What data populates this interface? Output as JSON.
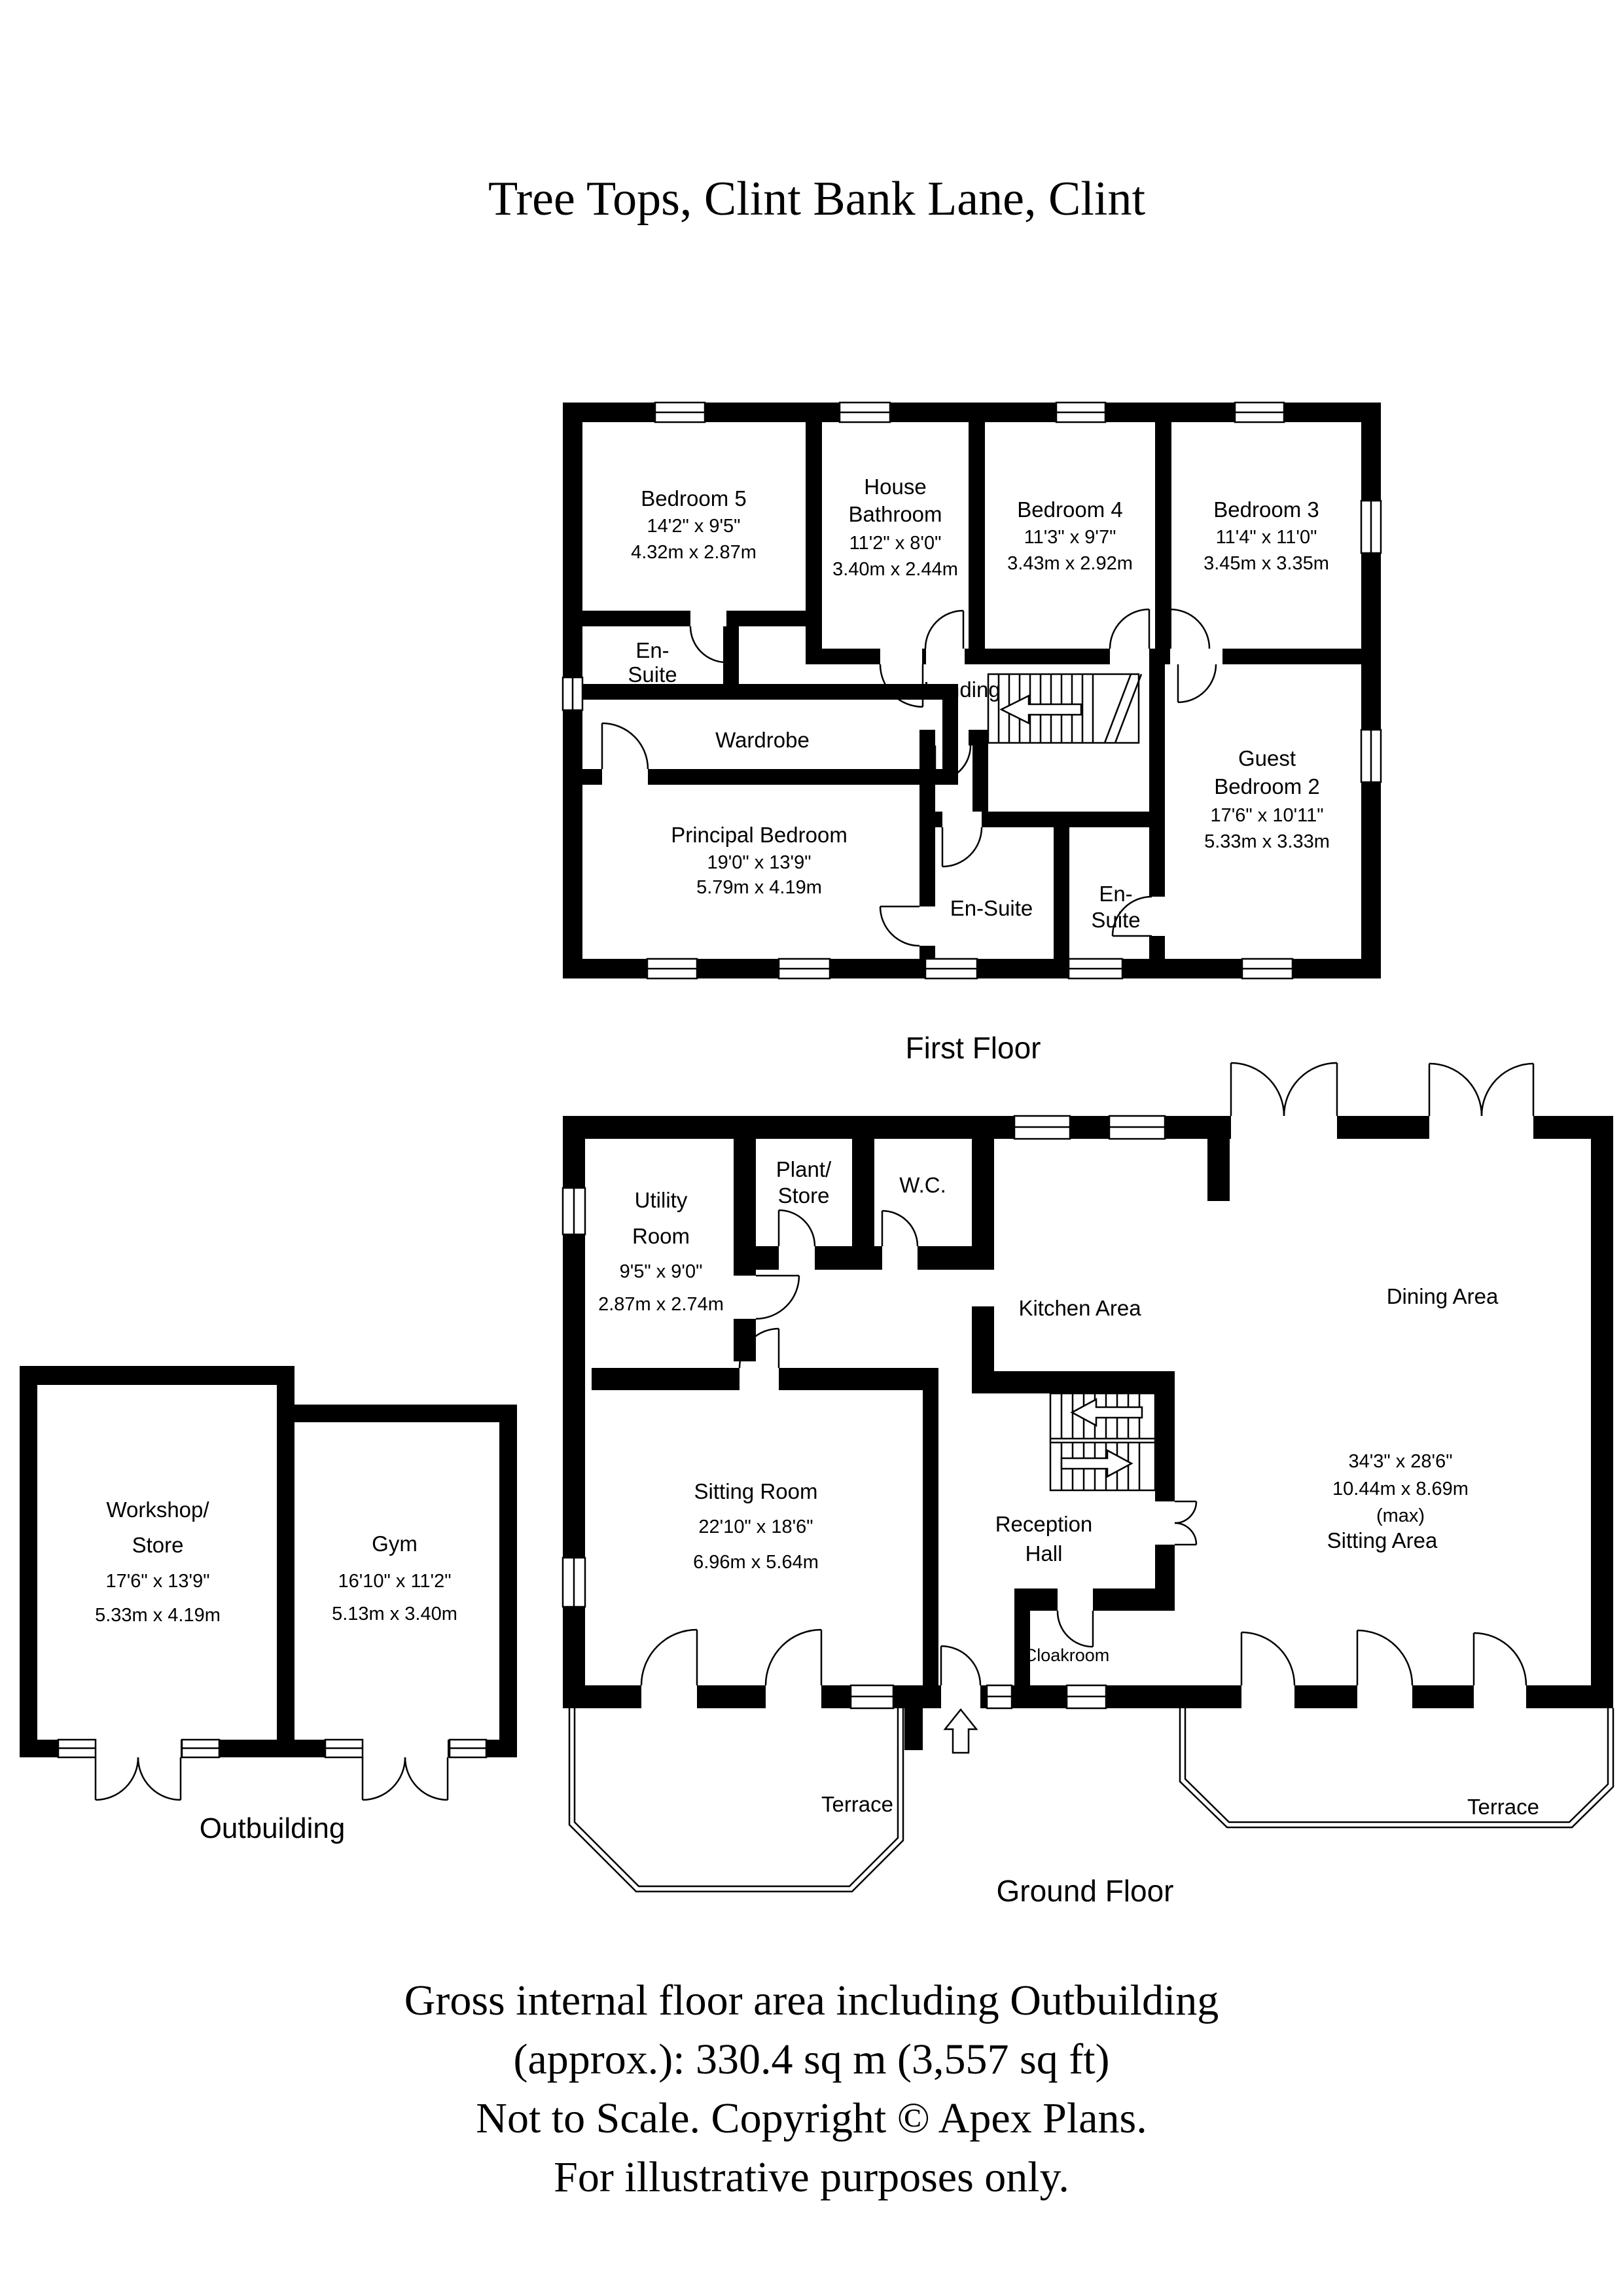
{
  "title": "Tree Tops, Clint Bank Lane, Clint",
  "first_floor": {
    "label": "First Floor",
    "rooms": {
      "bedroom5": {
        "name": "Bedroom 5",
        "dims_ft": "14'2\" x 9'5\"",
        "dims_m": "4.32m x 2.87m"
      },
      "house_bathroom": {
        "name_line1": "House",
        "name_line2": "Bathroom",
        "dims_ft": "11'2\" x 8'0\"",
        "dims_m": "3.40m x 2.44m"
      },
      "bedroom4": {
        "name": "Bedroom 4",
        "dims_ft": "11'3\" x 9'7\"",
        "dims_m": "3.43m x 2.92m"
      },
      "bedroom3": {
        "name": "Bedroom 3",
        "dims_ft": "11'4\" x 11'0\"",
        "dims_m": "3.45m x 3.35m"
      },
      "ensuite_left": {
        "line1": "En-",
        "line2": "Suite"
      },
      "wardrobe": {
        "name": "Wardrobe"
      },
      "landing": {
        "name": "Landing"
      },
      "principal_bedroom": {
        "name": "Principal Bedroom",
        "dims_ft": "19'0\" x 13'9\"",
        "dims_m": "5.79m x 4.19m"
      },
      "ensuite_mid": {
        "name": "En-Suite"
      },
      "ensuite_right": {
        "line1": "En-",
        "line2": "Suite"
      },
      "guest_bedroom2": {
        "name_line1": "Guest",
        "name_line2": "Bedroom 2",
        "dims_ft": "17'6\" x 10'11\"",
        "dims_m": "5.33m x 3.33m"
      }
    }
  },
  "ground_floor": {
    "label": "Ground Floor",
    "rooms": {
      "utility": {
        "name_line1": "Utility",
        "name_line2": "Room",
        "dims_ft": "9'5\" x 9'0\"",
        "dims_m": "2.87m x 2.74m"
      },
      "plant_store": {
        "line1": "Plant/",
        "line2": "Store"
      },
      "wc": {
        "name": "W.C."
      },
      "kitchen": {
        "name": "Kitchen Area"
      },
      "dining": {
        "name": "Dining Area",
        "dims_ft": "34'3\" x 28'6\"",
        "dims_m": "10.44m x 8.69m",
        "dims_note": "(max)"
      },
      "sitting_room": {
        "name": "Sitting Room",
        "dims_ft": "22'10\" x 18'6\"",
        "dims_m": "6.96m x 5.64m"
      },
      "reception": {
        "line1": "Reception",
        "line2": "Hall"
      },
      "cloakroom": {
        "name": "Cloakroom"
      },
      "sitting_area": {
        "name": "Sitting Area"
      },
      "terrace_left": {
        "name": "Terrace"
      },
      "terrace_right": {
        "name": "Terrace"
      }
    }
  },
  "outbuilding": {
    "label": "Outbuilding",
    "rooms": {
      "workshop": {
        "name_line1": "Workshop/",
        "name_line2": "Store",
        "dims_ft": "17'6\" x 13'9\"",
        "dims_m": "5.33m x 4.19m"
      },
      "gym": {
        "name": "Gym",
        "dims_ft": "16'10\" x 11'2\"",
        "dims_m": "5.13m x 3.40m"
      }
    }
  },
  "footer": {
    "lines": [
      "Gross internal floor area including Outbuilding",
      "(approx.): 330.4 sq m (3,557 sq ft)",
      "Not to Scale. Copyright © Apex Plans.",
      "For illustrative purposes only."
    ]
  }
}
